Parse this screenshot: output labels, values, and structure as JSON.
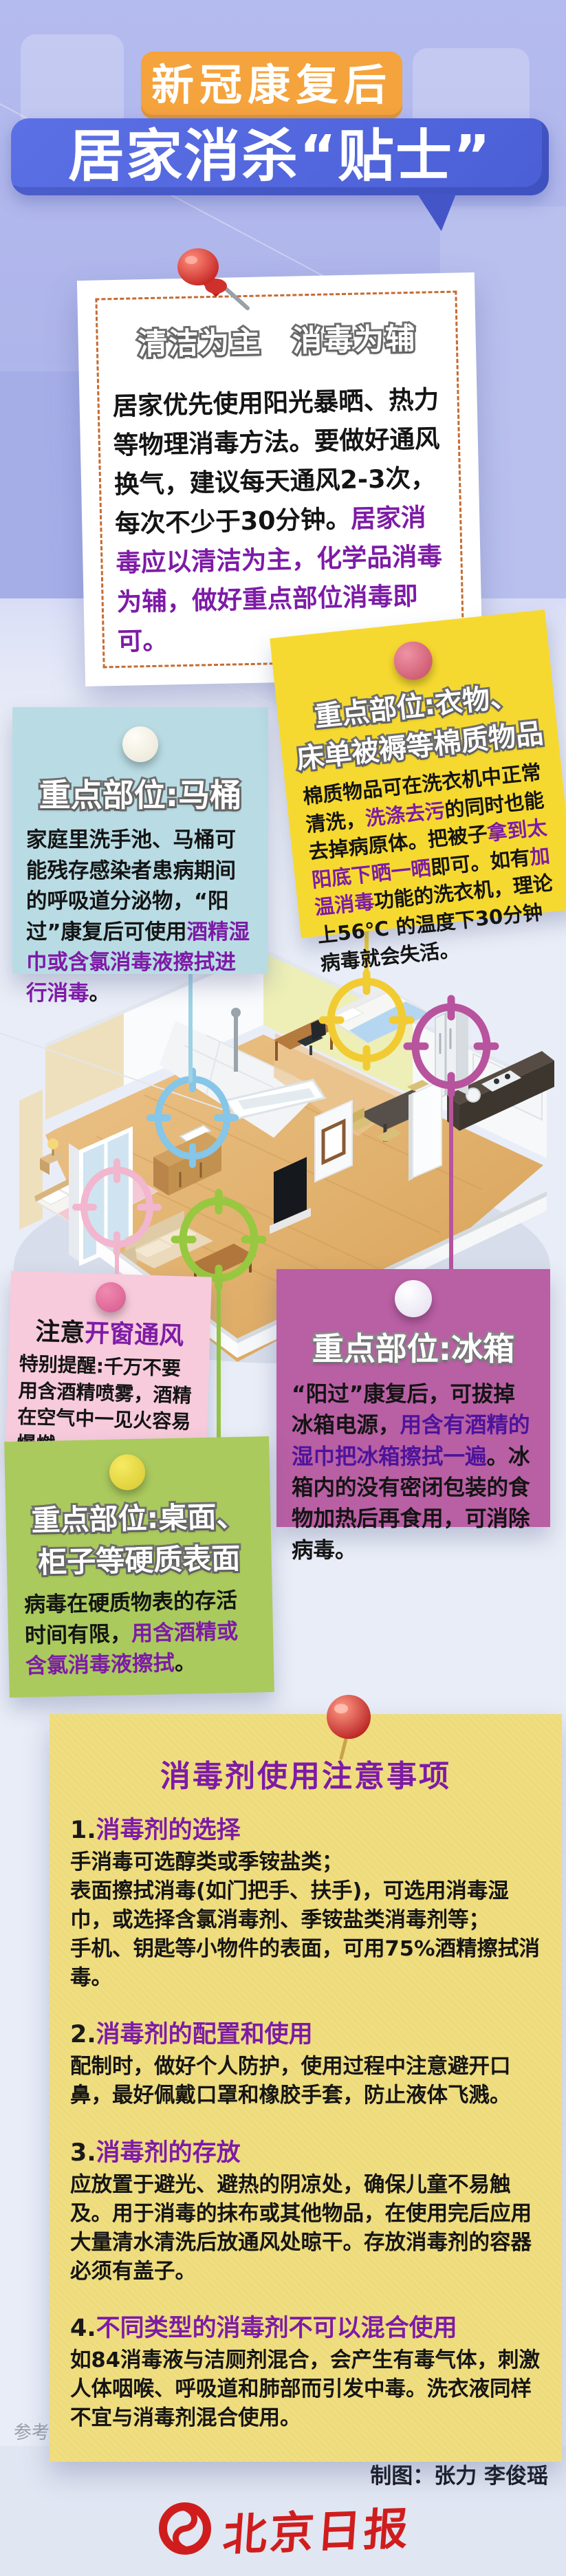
{
  "header": {
    "badge": "新冠康复后",
    "title": "居家消杀“贴士”"
  },
  "intro_card": {
    "title": "清洁为主　消毒为辅",
    "segments": [
      {
        "t": "居家优先使用阳光暴晒、热力等物理消毒方法。要做好通风换气，建议每天通风2-3次，每次不少于30分钟。"
      },
      {
        "t": "居家消毒应以清洁为主，化学品消毒为辅，做好重点部位消毒即可。",
        "c": "p"
      }
    ]
  },
  "notes": {
    "toilet": {
      "title": "重点部位:马桶",
      "segments": [
        {
          "t": "家庭里洗手池、马桶可能残存感染者患病期间的呼吸道分泌物，“阳过”康复后可使用"
        },
        {
          "t": "酒精湿巾或含氯消毒液擦拭进行消毒",
          "c": "p"
        },
        {
          "t": "。"
        }
      ]
    },
    "fabric": {
      "title_line1": "重点部位:衣物、",
      "title_line2": "床单被褥等棉质物品",
      "segments": [
        {
          "t": "棉质物品可在洗衣机中正常清洗，"
        },
        {
          "t": "洗涤去污",
          "c": "p"
        },
        {
          "t": "的同时也能去掉病原体。把被子"
        },
        {
          "t": "拿到太阳底下晒一晒",
          "c": "p"
        },
        {
          "t": "即可。如有"
        },
        {
          "t": "加温消毒",
          "c": "p"
        },
        {
          "t": "功能的洗衣机，理论上56℃ 的温度下30分钟病毒就会失活。"
        }
      ]
    },
    "window": {
      "title_segments": [
        {
          "t": "注意"
        },
        {
          "t": "开窗通风",
          "c": "p"
        }
      ],
      "segments": [
        {
          "t": "特别提醒:千万不要用含酒精喷雾，酒精在空气中一见火容易爆燃。"
        }
      ]
    },
    "fridge": {
      "title": "重点部位:冰箱",
      "segments": [
        {
          "t": "“阳过”康复后，可拔掉冰箱电源，"
        },
        {
          "t": "用含有酒精的湿巾把冰箱擦拭一遍",
          "c": "pd"
        },
        {
          "t": "。冰箱内的没有密闭包装的食物加热后再食用，可消除病毒。"
        }
      ]
    },
    "surfaces": {
      "title_line1": "重点部位:桌面、",
      "title_line2": "柜子等硬质表面",
      "segments": [
        {
          "t": "病毒在硬质物表的存活时间有限，"
        },
        {
          "t": "用含酒精或含氯消毒液擦拭",
          "c": "p"
        },
        {
          "t": "。"
        }
      ]
    }
  },
  "tips": {
    "title": "消毒剂使用注意事项",
    "sections": [
      {
        "num": "1.",
        "head": "消毒剂的选择",
        "body": "手消毒可选醇类或季铵盐类；\n表面擦拭消毒(如门把手、扶手)，可选用消毒湿巾，或选择含氯消毒剂、季铵盐类消毒剂等；\n手机、钥匙等小物件的表面，可用75%酒精擦拭消毒。"
      },
      {
        "num": "2.",
        "head": "消毒剂的配置和使用",
        "body": "配制时，做好个人防护，使用过程中注意避开口鼻，最好佩戴口罩和橡胶手套，防止液体飞溅。"
      },
      {
        "num": "3.",
        "head": "消毒剂的存放",
        "body": "应放置于避光、避热的阴凉处，确保儿童不易触及。用于消毒的抹布或其他物品，在使用完后应用大量清水清洗后放通风处晾干。存放消毒剂的容器必须有盖子。"
      },
      {
        "num": "4.",
        "head": "不同类型的消毒剂不可以混合使用",
        "body": "如84消毒液与洁厕剂混合，会产生有毒气体，刺激人体咽喉、呼吸道和肺部而引发中毒。洗衣液同样不宜与消毒剂混合使用。"
      }
    ]
  },
  "room": {
    "targets": [
      {
        "name": "toilet",
        "color": "#85c6e9"
      },
      {
        "name": "bed",
        "color": "#f2cb33"
      },
      {
        "name": "fridge",
        "color": "#b8539e"
      },
      {
        "name": "balcony-window",
        "color": "#f2b6ce"
      },
      {
        "name": "coffee-table",
        "color": "#97c840"
      }
    ]
  },
  "footer": {
    "source": "参考资料：北京新闻广播、中国疾控中心等",
    "credit": "制图：张力 李俊瑶",
    "logo_text": "北京日报"
  },
  "colors": {
    "badge_orange": "#f5a33c",
    "bubble_blue": "#4f63da",
    "note_cyan": "#b9dce4",
    "note_yellow": "#f6d930",
    "note_pink": "#f7cbdb",
    "note_purple": "#b95fa4",
    "note_green": "#aaca5d",
    "note_bigyellow": "#eedb7a",
    "highlight_purple": "#7d1ba6",
    "logo_red": "#cf1d1d"
  }
}
